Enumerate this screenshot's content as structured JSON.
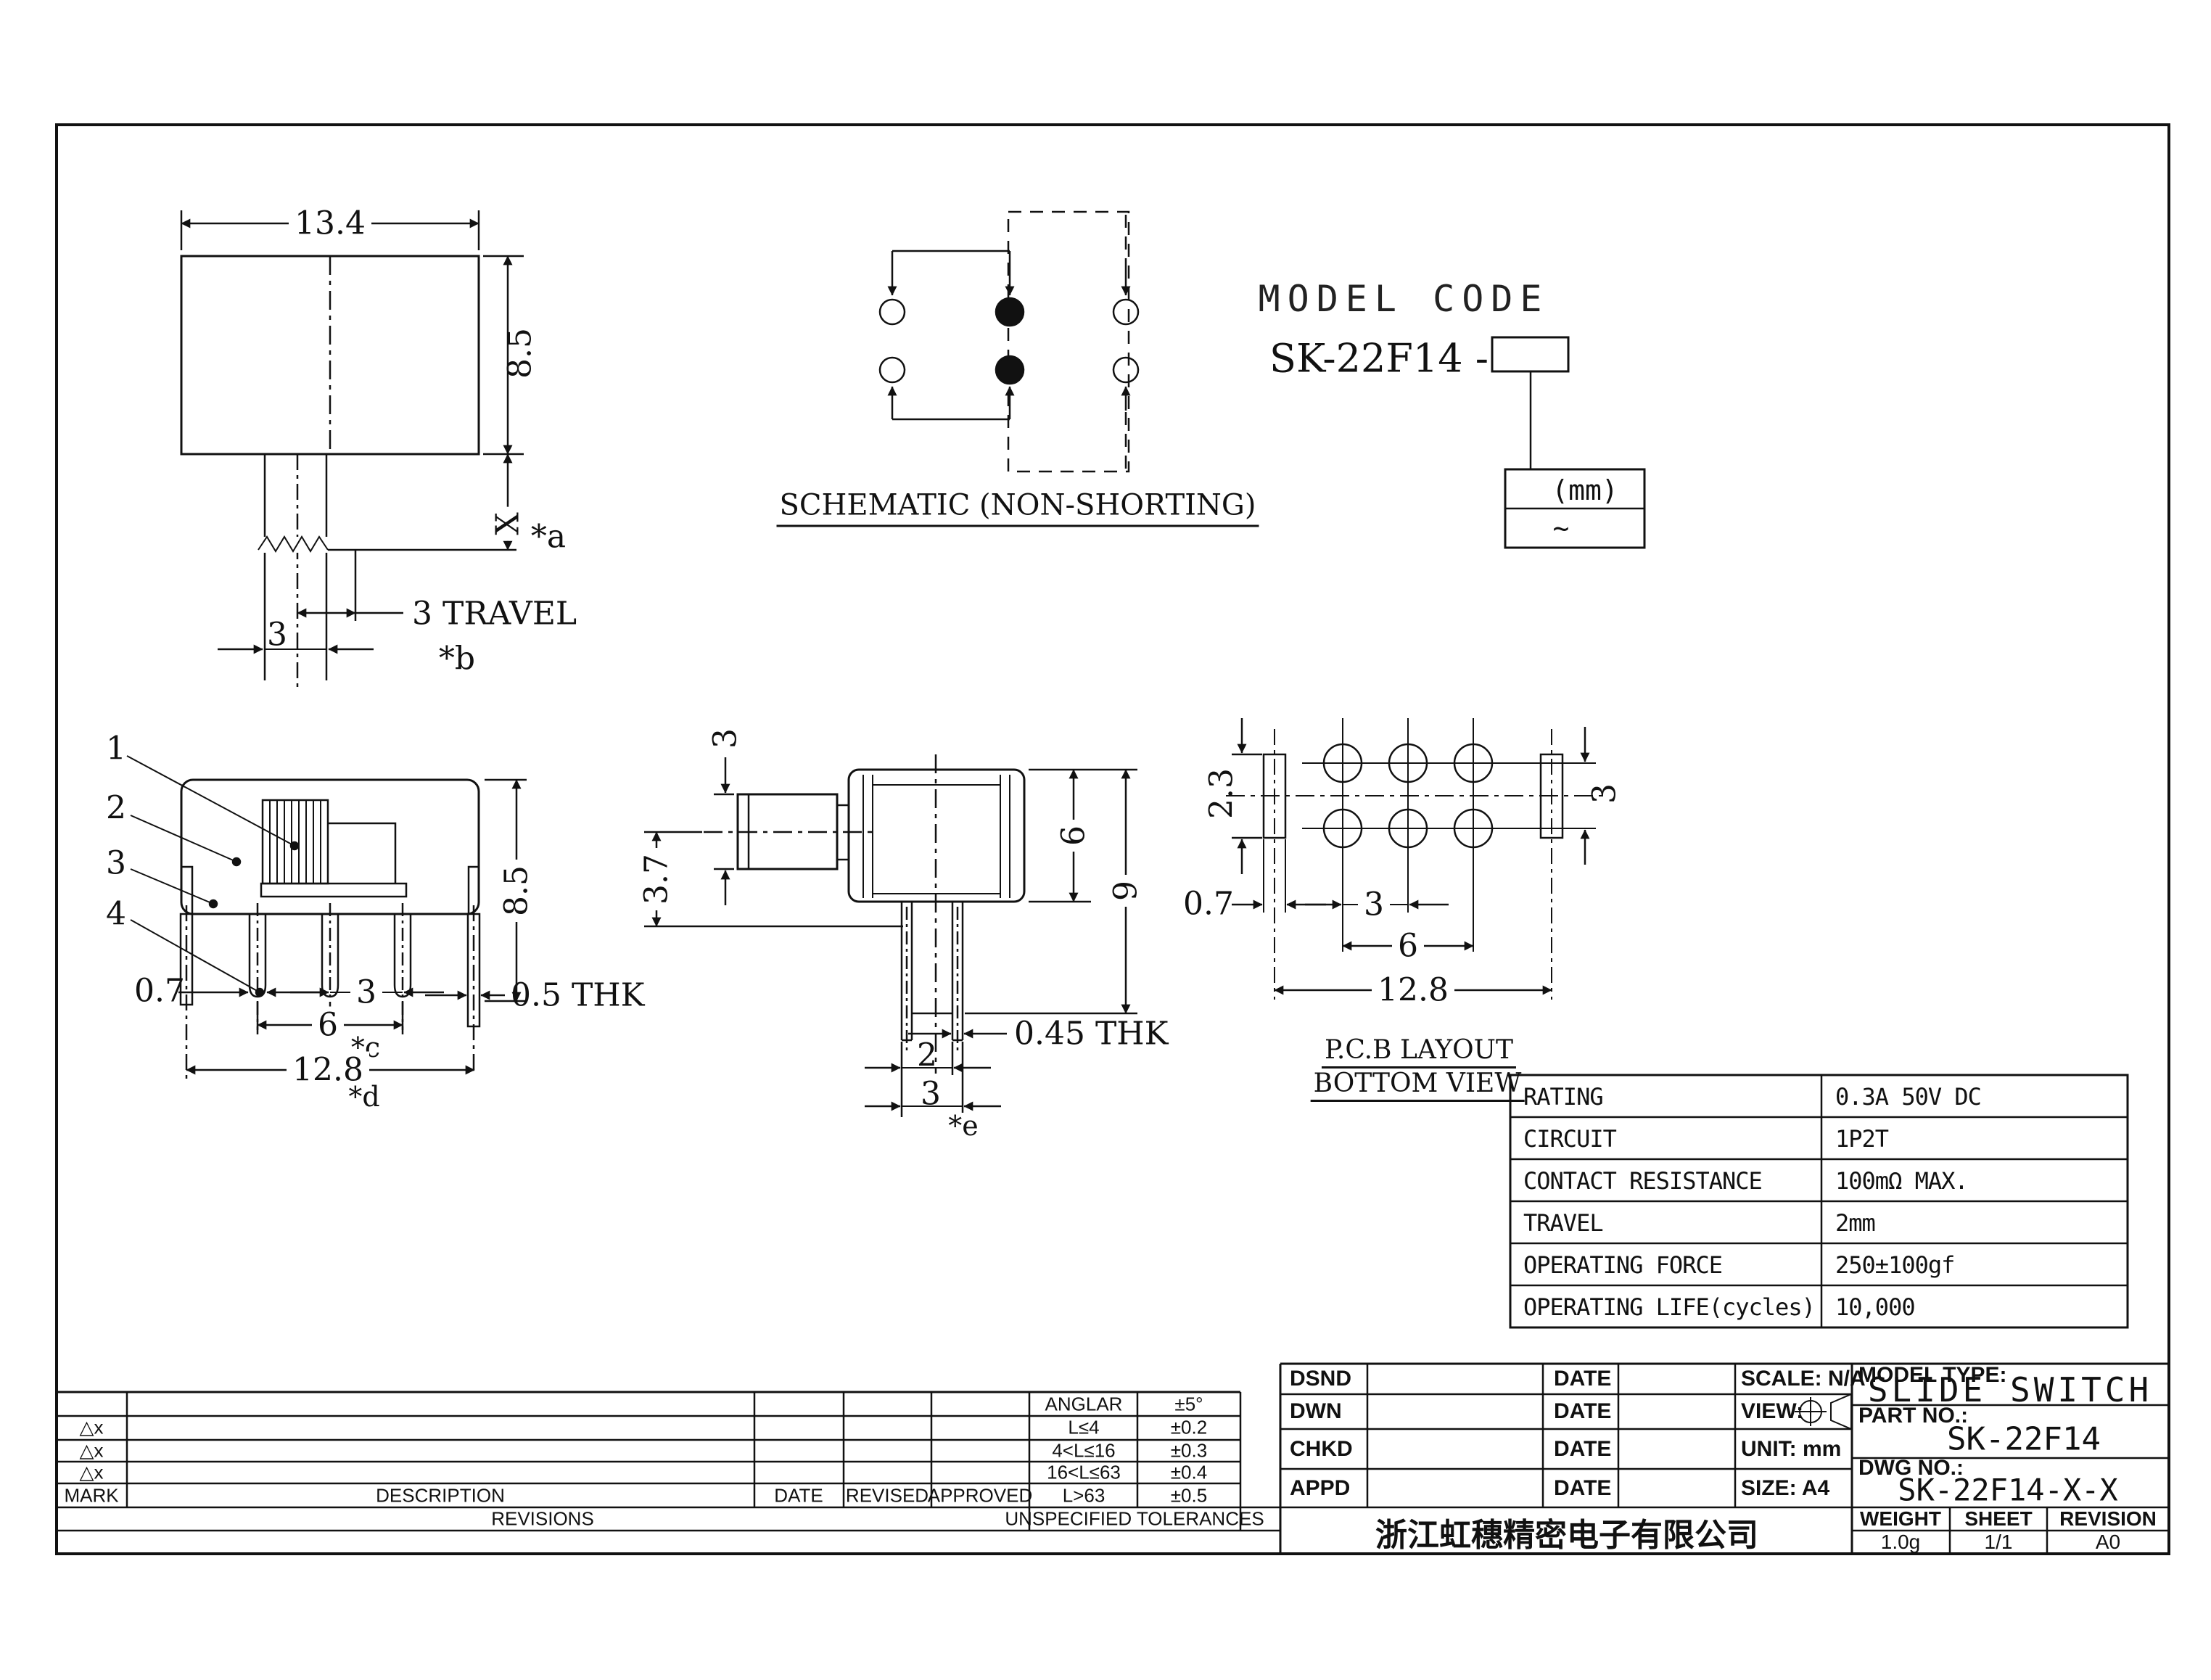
{
  "front_view": {
    "width": "13.4",
    "height": "8.5",
    "x_dim": "X",
    "note_a": "*a",
    "travel": "3 TRAVEL",
    "note_b": "*b",
    "pitch": "3"
  },
  "schematic": {
    "title": "SCHEMATIC (NON-SHORTING)"
  },
  "model_code": {
    "title": "MODEL CODE",
    "base": "SK-22F14 -",
    "mm": "(mm)",
    "tilde": "~"
  },
  "left_view": {
    "part1": "1",
    "part2": "2",
    "part3": "3",
    "part4": "4",
    "tab_w": "0.7",
    "pitch": "3",
    "span": "6",
    "note_c": "*c",
    "total": "12.8",
    "note_d": "*d",
    "height": "8.5",
    "thk": "0.5 THK"
  },
  "right_view": {
    "knob_h": "3",
    "knob_off": "3.7",
    "body_h": "6",
    "total_h": "9",
    "thk": "0.45 THK",
    "pitch2": "2",
    "pitch3": "3",
    "note_e": "*e"
  },
  "pcb_view": {
    "slot_h": "2.3",
    "slot_w": "0.7",
    "pitch": "3",
    "span": "6",
    "total": "12.8",
    "row_pitch": "3",
    "title1": "P.C.B LAYOUT",
    "title2": "BOTTOM VIEW"
  },
  "spec": {
    "rows": [
      {
        "label": "RATING",
        "value": "0.3A 50V DC"
      },
      {
        "label": "CIRCUIT",
        "value": "1P2T"
      },
      {
        "label": "CONTACT RESISTANCE",
        "value": "100mΩ MAX."
      },
      {
        "label": "TRAVEL",
        "value": "2mm"
      },
      {
        "label": "OPERATING FORCE",
        "value": "250±100gf"
      },
      {
        "label": "OPERATING LIFE(cycles)",
        "value": "10,000"
      }
    ]
  },
  "revisions": {
    "mark_symbol": "△x",
    "header": {
      "mark": "MARK",
      "description": "DESCRIPTION",
      "date": "DATE",
      "revised": "REVISED",
      "approved": "APPROVED"
    },
    "footer": "REVISIONS",
    "tol_header": "UNSPECIFIED TOLERANCES",
    "tol_rows": [
      {
        "range": "ANGLAR",
        "tol": "±5°"
      },
      {
        "range": "L≤4",
        "tol": "±0.2"
      },
      {
        "range": "4<L≤16",
        "tol": "±0.3"
      },
      {
        "range": "16<L≤63",
        "tol": "±0.4"
      },
      {
        "range": "L>63",
        "tol": "±0.5"
      }
    ]
  },
  "title_block": {
    "dsnd": "DSND",
    "dwn": "DWN",
    "chkd": "CHKD",
    "appd": "APPD",
    "date": "DATE",
    "scale": "SCALE: N/A",
    "view": "VIEW:",
    "unit": "UNIT: mm",
    "size": "SIZE: A4",
    "model_type_label": "MODEL TYPE:",
    "model_type": "SLIDE SWITCH",
    "part_no_label": "PART NO.:",
    "part_no": "SK-22F14",
    "dwg_no_label": "DWG NO.:",
    "dwg_no": "SK-22F14-X-X",
    "weight_label": "WEIGHT",
    "weight": "1.0g",
    "sheet_label": "SHEET",
    "sheet": "1/1",
    "revision_label": "REVISION",
    "revision": "A0",
    "company": "浙江虹穗精密电子有限公司"
  }
}
